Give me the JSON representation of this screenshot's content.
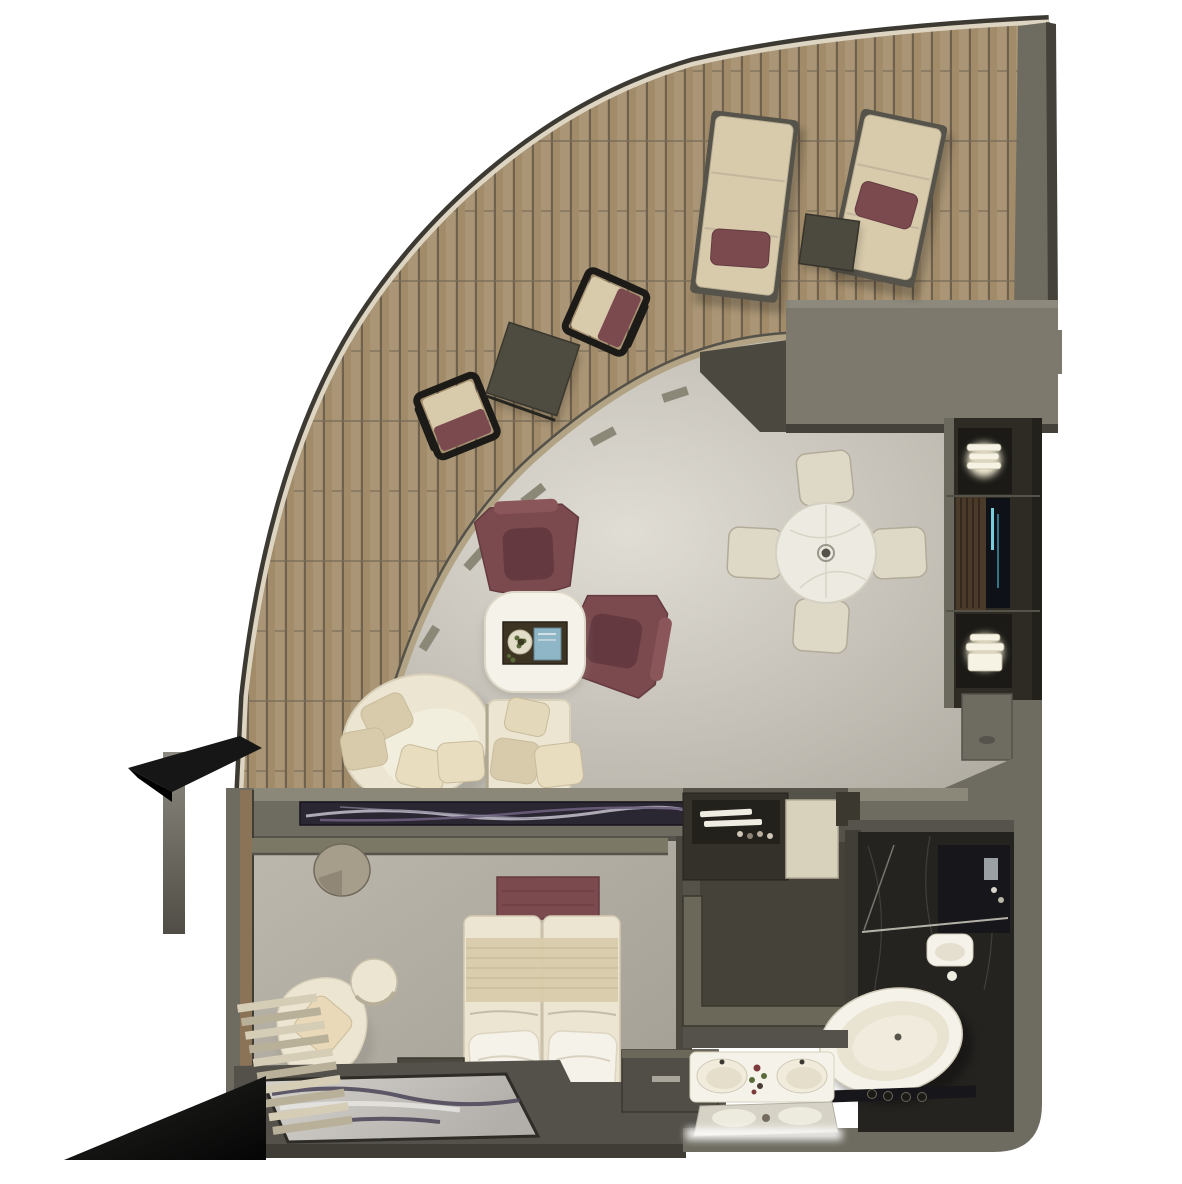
{
  "meta": {
    "kind": "floor-plan-render",
    "view": "top-down-3d",
    "subject": "luxury suite floor plan with curved private teak deck, living-dining room, bedroom and marble bathroom"
  },
  "palette": {
    "bg": "#ffffff",
    "hull_dark": "#3c3a32",
    "hull_light": "#ddd5c2",
    "wood": "#a18b69",
    "wood_dark": "#6e6150",
    "wood_light": "#b7a485",
    "deck_wall_tan": "#b2a384",
    "wall_gray": "#6e6b60",
    "wall_gray_dark": "#4a483f",
    "wall_gray_light": "#8b887a",
    "entry_block": "#7d7a6d",
    "floor_living_bright": "#dcd9d1",
    "floor_living": "#b8b4aa",
    "floor_bed": "#b0aca2",
    "platform_dark": "#53514a",
    "maroon": "#7b4a4e",
    "maroon_dark": "#643a40",
    "cream": "#ece5d2",
    "cream_dark": "#d8cbab",
    "white_soft": "#f5f2ea",
    "marble_white": "#eceae1",
    "tray_dark": "#3e3424",
    "charcoal": "#17161a",
    "bath_floor": "#242320",
    "media_dark": "#2e2b25",
    "media_wood": "#4a3a2a",
    "tv_screen": "#0e1218",
    "tv_glow": "#7fd8e8",
    "lamp_glow": "#fff9e0",
    "rug_base": "#c9c6c1",
    "rug_vein": "#4a4458",
    "stool_tan": "#a69d8b",
    "blind_light": "#d6cdb6",
    "blind_dark": "#b9b09a",
    "black": "#101010",
    "book_blue": "#8fb6c6",
    "plant_green": "#5a6b3a",
    "flower_red": "#7d3b3b"
  },
  "rooms": {
    "deck": {
      "name": "private deck",
      "items": [
        "sun lounger",
        "sun lounger",
        "lounger side table",
        "deck chair",
        "deck chair",
        "deck dining table"
      ]
    },
    "living": {
      "name": "living room",
      "items": [
        "curved sofa",
        "chaise module",
        "coffee table with tray",
        "armchair",
        "armchair",
        "media wall with tv and lamps"
      ]
    },
    "dining": {
      "name": "dining area",
      "items": [
        "round marble table",
        "chair",
        "chair",
        "chair",
        "chair"
      ]
    },
    "bedroom": {
      "name": "bedroom",
      "items": [
        "twin beds",
        "foot bench",
        "pillows",
        "desk with stool",
        "swivel chair",
        "pouf",
        "marble rug",
        "nightstand",
        "louvre bench"
      ]
    },
    "closet": {
      "name": "walk-in wardrobe",
      "items": [
        "dresser",
        "storage cube",
        "l-shaped shelving"
      ]
    },
    "bathroom": {
      "name": "bathroom",
      "items": [
        "freestanding bathtub",
        "double sink vanity",
        "mirror",
        "toilet",
        "shower"
      ]
    }
  }
}
